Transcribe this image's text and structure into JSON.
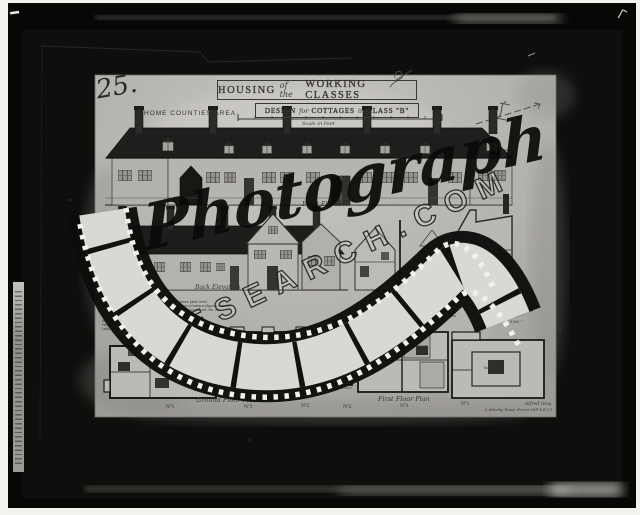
{
  "sheet": {
    "plate_number": "25.",
    "region_label": "HOME COUNTIES AREA",
    "title": {
      "word1": "HOUSING",
      "word2": "of the",
      "word3": "WORKING CLASSES"
    },
    "subtitle": {
      "word1": "DESIGN",
      "word2": "for",
      "word3": "COTTAGES",
      "word4": "in",
      "word5": "CLASS \"B\""
    },
    "scale_caption": "Scale in Feet",
    "labels": {
      "front_elevation": "Front Elevation",
      "back_elevation": "Back Elevation",
      "ground_floor_plan": "Ground Floor Plan",
      "first_floor_plan": "First Floor Plan"
    },
    "unit_numbers": [
      "Nº1",
      "Nº3",
      "Nº2",
      "Nº2",
      "Nº3",
      "Nº1"
    ],
    "room_labels": {
      "entrance_1": "Entrance",
      "entrance_2": "Entrance",
      "bedroom_1": "Bedroom",
      "bedroom_2": "Bedroom",
      "bedroom_3": "Bedroom"
    },
    "notes_left": {
      "heading": "Materials",
      "para1": [
        "Walls 11in brickwork with rough cast finish above plinth level",
        "Roofs covered with hand made sand faced tiles on battens (figured boards)",
        "Floors: concrete to ground floor, deal boarding on joists over, etc. etc."
      ],
      "para2": [
        "Casement windows with leaded lights",
        "Internal walls plastered and distempered",
        "Height of rooms 8ft 0in",
        "Larder and fuel store to each cottage"
      ]
    },
    "notes_right": {
      "heading": "Cubical Contents",
      "rows": [
        {
          "item": "One of semi-detached houses",
          "value": "1,912 cub feet"
        },
        {
          "item": "Terrace house ground and first floors",
          "value": "2,840  ″  ″"
        },
        {
          "item": "House with three bedrooms",
          "value": "5,040  ″  ″"
        }
      ]
    },
    "signature": {
      "line1": "Alfred Gow,",
      "line2": "5 Allenby Road, Forest Hill S.E.23"
    }
  },
  "watermark": {
    "script_text": "Photograph",
    "outline_text": "RESEARCH.COM"
  },
  "colors": {
    "paper": "#b7b5b0",
    "ink": "#35332f",
    "roof": "#1d1d1b",
    "plate_black": "#070706",
    "frame_white": "#f3f2ef"
  }
}
